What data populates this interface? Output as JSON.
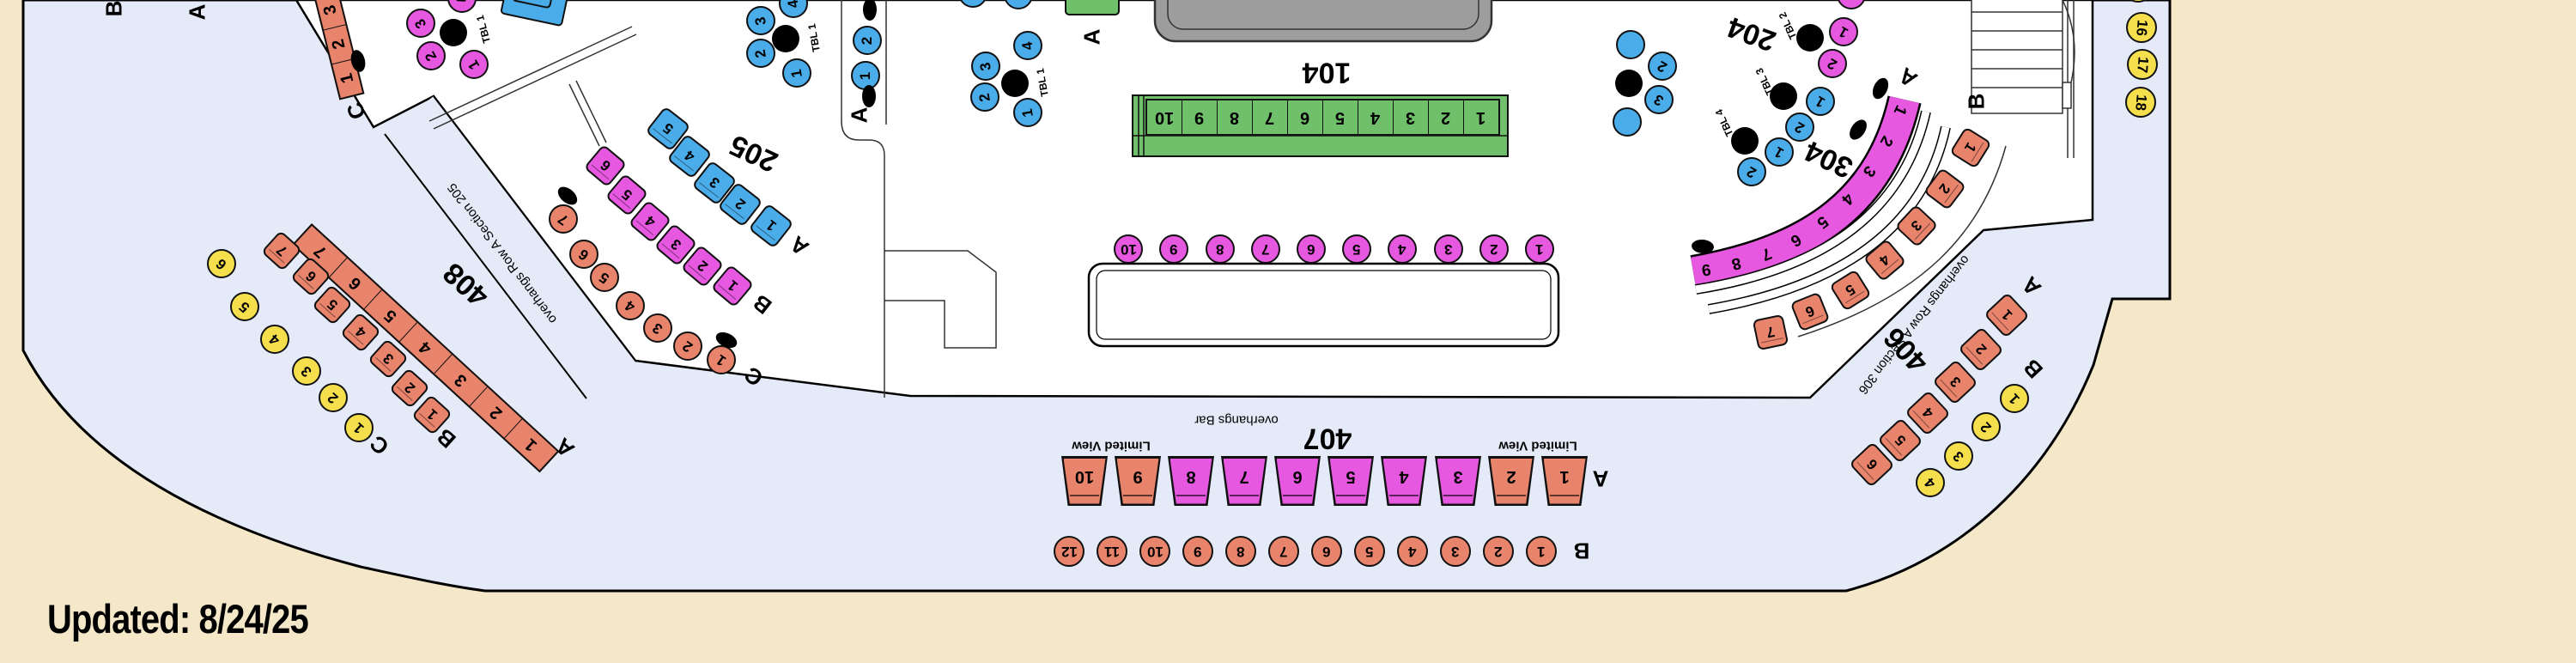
{
  "updated_label": "Updated: 8/24/25",
  "colors": {
    "background": "#F5E8C9",
    "floor_white": "#FFFFFF",
    "overhang_blue": "#E4EAF8",
    "salmon": "#E8846C",
    "yellow": "#F5DF4D",
    "magenta": "#E658E0",
    "blue": "#4BACEA",
    "green": "#70BF6A",
    "stage_gray": "#9D9D9D"
  },
  "sections": {
    "s104": {
      "label": "104",
      "rows": [
        {
          "label": "",
          "seats": [
            "1",
            "2",
            "3",
            "4",
            "5",
            "6",
            "7",
            "8",
            "9",
            "10"
          ]
        }
      ]
    },
    "s204": {
      "label": "204"
    },
    "s205": {
      "label": "205",
      "rows": [
        {
          "label": "A",
          "seats": [
            "1",
            "2",
            "3",
            "4",
            "5"
          ]
        },
        {
          "label": "B",
          "seats": [
            "1",
            "2",
            "3",
            "4",
            "5",
            "6"
          ]
        },
        {
          "label": "C",
          "seats": [
            "1",
            "2",
            "3",
            "4",
            "5",
            "6",
            "7"
          ]
        }
      ]
    },
    "s304": {
      "label": "304",
      "rows": [
        {
          "label": "A",
          "seats": [
            "1",
            "2",
            "3",
            "4",
            "5",
            "6",
            "7",
            "8",
            "9"
          ]
        },
        {
          "label": "B",
          "seats": [
            "1",
            "2",
            "3",
            "4",
            "5",
            "6",
            "7"
          ]
        }
      ]
    },
    "s406": {
      "label": "406",
      "note": "overhangs Row A Section 306",
      "rows": [
        {
          "label": "A",
          "seats": [
            "1",
            "2",
            "3",
            "4",
            "5",
            "6"
          ]
        },
        {
          "label": "B",
          "seats": [
            "1",
            "2",
            "3",
            "4"
          ]
        }
      ]
    },
    "s407": {
      "label": "407",
      "note": "overhangs Bar",
      "limited_view": "Limited View",
      "rows": [
        {
          "label": "A",
          "seats": [
            "1",
            "2",
            "3",
            "4",
            "5",
            "6",
            "7",
            "8",
            "9",
            "10"
          ]
        },
        {
          "label": "B",
          "seats": [
            "1",
            "2",
            "3",
            "4",
            "5",
            "6",
            "7",
            "8",
            "9",
            "10",
            "11",
            "12"
          ]
        }
      ]
    },
    "s408": {
      "label": "408",
      "note": "overhangs Row A Section 205",
      "rows": [
        {
          "label": "A",
          "seats": [
            "1",
            "2",
            "3",
            "4",
            "5",
            "6",
            "7"
          ]
        },
        {
          "label": "B",
          "seats": [
            "1",
            "2",
            "3",
            "4",
            "5",
            "6",
            "7"
          ]
        },
        {
          "label": "C",
          "seats": [
            "1",
            "2",
            "3",
            "4",
            "5",
            "6"
          ]
        }
      ]
    },
    "wedge": {
      "rows": [
        {
          "label": "C",
          "seats": [
            "1",
            "2",
            "3"
          ]
        }
      ]
    },
    "astrip": {
      "rows": [
        {
          "label": "A",
          "seats": [
            "1",
            "2"
          ]
        }
      ]
    },
    "green_chair": {
      "row_label": "A"
    },
    "rail": {
      "rows": [
        {
          "label": "",
          "seats": [
            "16",
            "17",
            "18"
          ]
        }
      ]
    },
    "top_left_labels": [
      "B",
      "A"
    ]
  },
  "bar": {
    "rows": [
      {
        "label": "",
        "seats": [
          "1",
          "2",
          "3",
          "4",
          "5",
          "6",
          "7",
          "8",
          "9",
          "10"
        ]
      }
    ]
  },
  "tables": {
    "t1m": {
      "label": "TBL 1",
      "seats": [
        "1",
        "2",
        "3",
        "4"
      ]
    },
    "t1a": {
      "label": "TBL 1",
      "seats": [
        "1",
        "2",
        "3",
        "4"
      ]
    },
    "t1b": {
      "label": "TBL 1",
      "seats": [
        "1",
        "2",
        "3",
        "4"
      ]
    },
    "t2": {
      "label": "TBL 2",
      "seats": [
        "1",
        "2"
      ]
    },
    "t3": {
      "label": "TBL 3",
      "seats": [
        "1",
        "2"
      ]
    },
    "t4": {
      "label": "TBL 4",
      "seats": [
        "1",
        "2"
      ]
    },
    "t5": {
      "label": "",
      "seats": [
        "2",
        "3"
      ]
    }
  }
}
